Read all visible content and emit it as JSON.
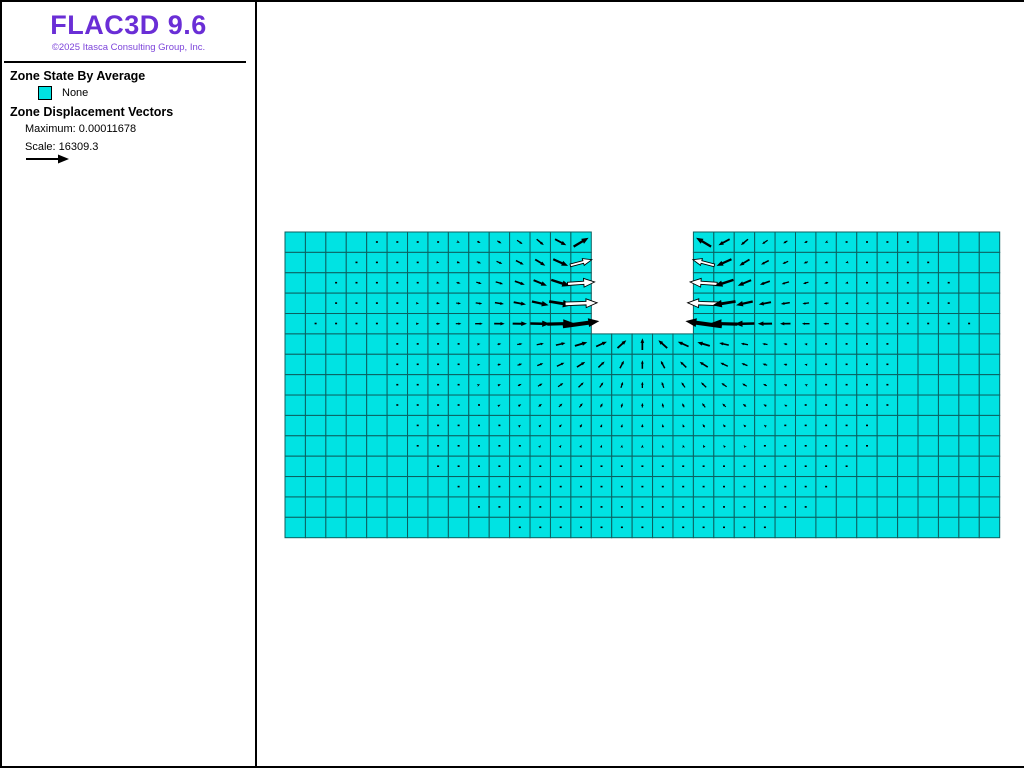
{
  "app": {
    "title": "FLAC3D 9.6",
    "copyright": "©2025 Itasca Consulting Group, Inc."
  },
  "colors": {
    "title": "#6A2ED6",
    "copyright": "#7D44DA",
    "zone_fill": "#00E3E3",
    "grid_line": "#0B6060",
    "vector": "#000000",
    "window_border": "#000000"
  },
  "legend": {
    "zone_state": {
      "heading": "Zone State By Average",
      "items": [
        {
          "label": "None",
          "color": "#00E3E3"
        }
      ]
    },
    "displacement": {
      "heading": "Zone Displacement Vectors",
      "maximum_label": "Maximum:",
      "maximum_value": "0.00011678",
      "scale_label": "Scale:",
      "scale_value": "16309.3"
    }
  },
  "chart_data": {
    "type": "heatmap",
    "description": "2D zone mesh (all zones state None, cyan) with excavated notch; displacement vector field converging on the excavation",
    "mesh": {
      "origin_x": 283,
      "origin_y": 230,
      "cols": 35,
      "rows": 15,
      "cell_w": 20.42,
      "cell_h": 20.38,
      "notch": {
        "col_start": 15,
        "col_end": 19,
        "row_start": 0,
        "row_end": 4
      }
    },
    "vectors": {
      "maximum": 0.00011678,
      "scale": 16309.3,
      "max_len_px": 46,
      "decay_px": 65,
      "under_floor_factor": 0.3,
      "side_below_floor_factor": 0.35,
      "depth_min_factor": 0.38,
      "target_dy": 8,
      "wall_blend_cols": 2,
      "up_dir_x": 0.55,
      "up_dir_y": -0.85
    }
  }
}
